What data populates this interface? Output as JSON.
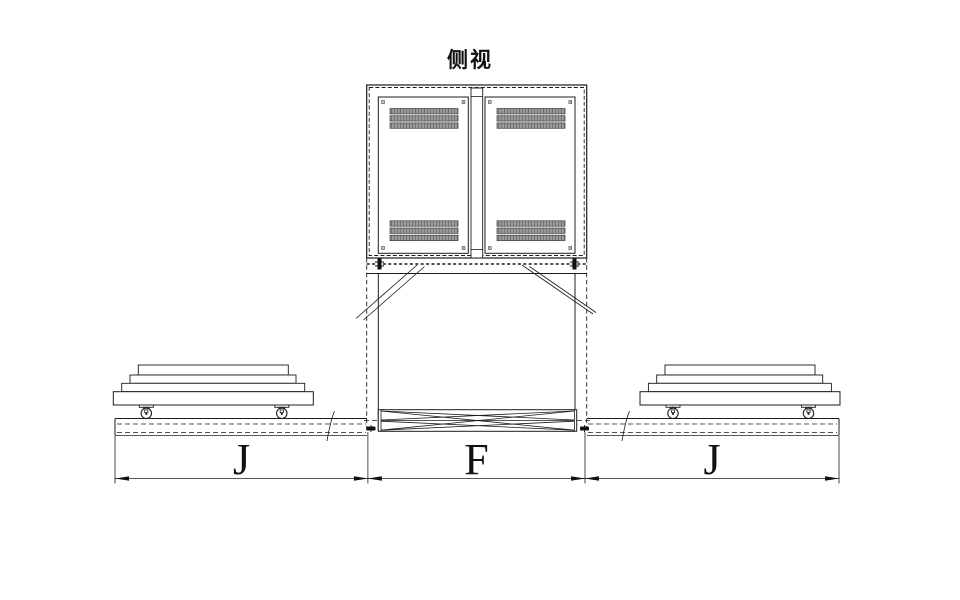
{
  "title": "侧视",
  "dimension_labels": {
    "left_span": "J",
    "center_span": "F",
    "right_span": "J"
  },
  "colors": {
    "background": "#ffffff",
    "line": "#1c1c1c",
    "vent_fill": "#9a9a9a",
    "vent_stripe": "#6f6f6f",
    "bolt": "#111111"
  }
}
